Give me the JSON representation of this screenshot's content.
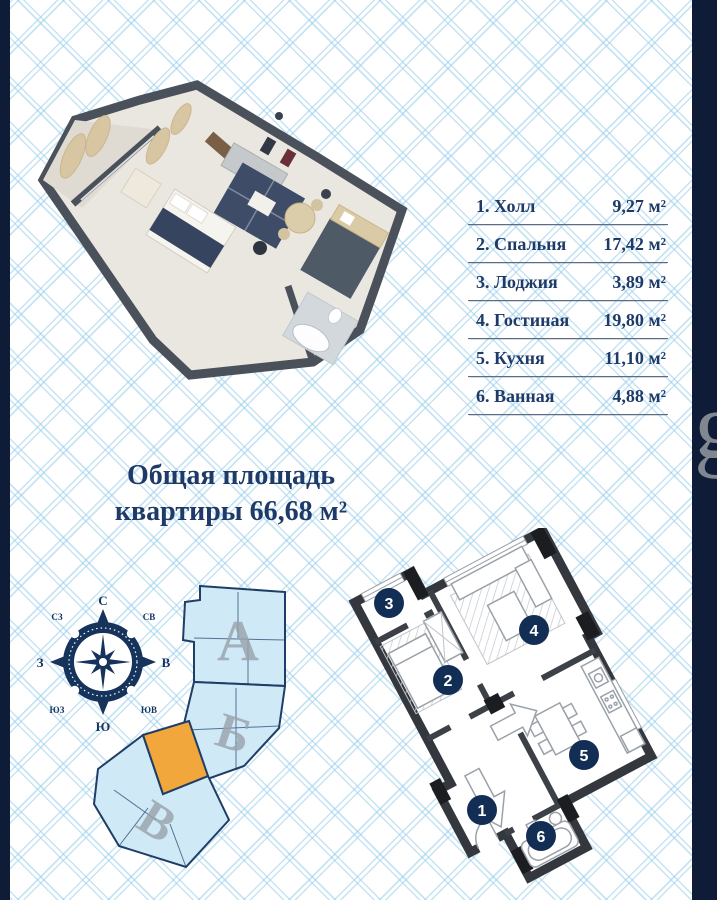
{
  "palette": {
    "navy_text": "#1e3a68",
    "side_bar": "#0e1c38",
    "pattern_line": "#bfe0f2",
    "accent_orange": "#f1a73c",
    "site_fill": "#cfe9f6",
    "wall_dark": "#34383e",
    "badge_navy": "#132e54",
    "section_letter_gray": "#99a3ac"
  },
  "room_list": {
    "rows": [
      {
        "label": "1. Холл",
        "value": "9,27 м²"
      },
      {
        "label": "2. Спальня",
        "value": "17,42 м²"
      },
      {
        "label": "3. Лоджия",
        "value": "3,89 м²"
      },
      {
        "label": "4. Гостиная",
        "value": "19,80 м²"
      },
      {
        "label": "5. Кухня",
        "value": "11,10 м²"
      },
      {
        "label": "6. Ванная",
        "value": "4,88 м²"
      }
    ]
  },
  "total_area": {
    "line1": "Общая площадь",
    "line2": "квартиры 66,68 м²"
  },
  "compass": {
    "n": "С",
    "ne": "СВ",
    "e": "В",
    "se": "ЮВ",
    "s": "Ю",
    "sw": "ЮЗ",
    "w": "З",
    "nw": "СЗ"
  },
  "site_plan": {
    "sections": [
      {
        "label": "А"
      },
      {
        "label": "Б"
      },
      {
        "label": "В"
      }
    ]
  },
  "floor_plan_2d": {
    "room_numbers": [
      "1",
      "2",
      "3",
      "4",
      "5",
      "6"
    ]
  },
  "watermark": {
    "text": "g"
  }
}
